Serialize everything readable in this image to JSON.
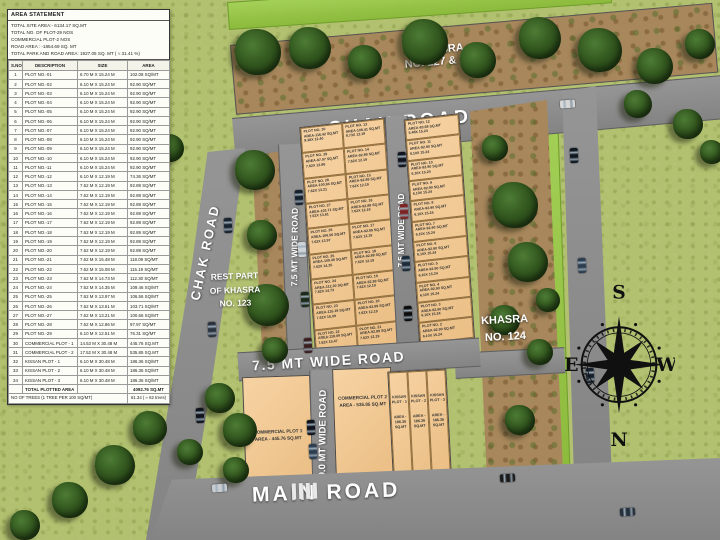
{
  "area_statement": {
    "title": "AREA STATEMENT",
    "summary_lines": [
      "TOTAL SITE AREA:- 6134.17 SQ.MT",
      "TOTAL NO. OF PLOT-29 NOS",
      "COMMERCIAL PLOT-2 NOS",
      "ROAD AREA : -1854.69 SQ. MT",
      "TOTAL PARK AND ROAD AREA: 1927.05 SQ. MT ( ≈ 31.41 %)"
    ],
    "columns": [
      "S.NO",
      "DESCRIPTION",
      "SIZE",
      "AREA"
    ],
    "rows": [
      [
        "1",
        "PLOT NO.-01",
        "6.70 M X 15.24 M",
        "102.08 SQ/MT"
      ],
      [
        "2",
        "PLOT NO.-02",
        "6.10 M X 15.24 M",
        "92.90 SQ/MT"
      ],
      [
        "3",
        "PLOT NO.-03",
        "6.10 M X 15.24 M",
        "92.90 SQ/MT"
      ],
      [
        "4",
        "PLOT NO.-04",
        "6.10 M X 15.24 M",
        "92.90 SQ/MT"
      ],
      [
        "5",
        "PLOT NO.-05",
        "6.10 M X 15.24 M",
        "92.90 SQ/MT"
      ],
      [
        "6",
        "PLOT NO.-06",
        "6.10 M X 15.24 M",
        "92.90 SQ/MT"
      ],
      [
        "7",
        "PLOT NO.-07",
        "6.10 M X 15.24 M",
        "92.90 SQ/MT"
      ],
      [
        "8",
        "PLOT NO.-08",
        "6.10 M X 15.24 M",
        "92.90 SQ/MT"
      ],
      [
        "9",
        "PLOT NO.-09",
        "6.10 M X 15.24 M",
        "92.90 SQ/MT"
      ],
      [
        "10",
        "PLOT NO.-10",
        "6.10 M X 15.24 M",
        "92.90 SQ/MT"
      ],
      [
        "11",
        "PLOT NO.-11",
        "6.10 M X 15.24 M",
        "92.90 SQ/MT"
      ],
      [
        "12",
        "PLOT NO.-12",
        "6.10 M X 12.19 M",
        "74.36 SQ/MT"
      ],
      [
        "13",
        "PLOT NO.-13",
        "7.62 M X 12.19 M",
        "92.89 SQ/MT"
      ],
      [
        "14",
        "PLOT NO.-14",
        "7.62 M X 12.19 M",
        "92.89 SQ/MT"
      ],
      [
        "15",
        "PLOT NO.-15",
        "7.62 M X 12.19 M",
        "92.89 SQ/MT"
      ],
      [
        "16",
        "PLOT NO.-16",
        "7.62 M X 12.19 M",
        "92.89 SQ/MT"
      ],
      [
        "17",
        "PLOT NO.-17",
        "7.62 M X 12.19 M",
        "92.89 SQ/MT"
      ],
      [
        "18",
        "PLOT NO.-18",
        "7.62 M X 12.19 M",
        "92.89 SQ/MT"
      ],
      [
        "19",
        "PLOT NO.-19",
        "7.62 M X 12.19 M",
        "92.89 SQ/MT"
      ],
      [
        "20",
        "PLOT NO.-20",
        "7.62 M X 12.19 M",
        "92.89 SQ/MT"
      ],
      [
        "21",
        "PLOT NO.-21",
        "7.62 M X 15.48 M",
        "118.09 SQ/MT"
      ],
      [
        "22",
        "PLOT NO.-22",
        "7.62 M X 15.08 M",
        "115.19 SQ/MT"
      ],
      [
        "23",
        "PLOT NO.-23",
        "7.62 M X 14.73 M",
        "112.30 SQ/MT"
      ],
      [
        "24",
        "PLOT NO.-24",
        "7.62 M X 14.35 M",
        "109.46 SQ/MT"
      ],
      [
        "25",
        "PLOT NO.-25",
        "7.62 M X 13.97 M",
        "106.56 SQ/MT"
      ],
      [
        "26",
        "PLOT NO.-26",
        "7.62 M X 13.61 M",
        "103.71 SQ/MT"
      ],
      [
        "27",
        "PLOT NO.-27",
        "7.62 M X 13.21 M",
        "100.66 SQ/MT"
      ],
      [
        "28",
        "PLOT NO.-28",
        "7.62 M X 12.86 M",
        "97.97 SQ/MT"
      ],
      [
        "29",
        "PLOT NO.-29",
        "6.10 M X 12.51 M",
        "76.31 SQ/MT"
      ],
      [
        "30",
        "COMMERCIAL PLOT - 1",
        "14.53 M X 30.48 M",
        "445.76 SQ.MT"
      ],
      [
        "31",
        "COMMERCIAL PLOT - 2",
        "17.52 M X 30.48 M",
        "535.85 SQ.MT"
      ],
      [
        "32",
        "KISSAN PLOT - 1",
        "6.10 M X 30.48 M",
        "186.36 SQ/MT"
      ],
      [
        "33",
        "KISSAN PLOT - 2",
        "6.10 M X 30.48 M",
        "186.36 SQ/MT"
      ],
      [
        "34",
        "KISSAN PLOT - 3",
        "6.10 M X 30.48 M",
        "186.36 SQ/MT"
      ]
    ],
    "total_row": {
      "label": "TOTAL PLOTTED AREA",
      "value": "4092.76 SQ.MT"
    },
    "trees_row": {
      "label": "NO OF TREES (1 TREE PER 100 SQ/MT)",
      "value": "61.34 ( ≈ 62 trees)"
    }
  },
  "plan": {
    "khasra_top": {
      "line1": "KHASRA",
      "line2": "NO. 127 & 128"
    },
    "khasra_right": {
      "line1": "KHASRA",
      "line2": "NO. 124"
    },
    "khasra_rest": {
      "line1": "REST PART",
      "line2": "OF KHASRA",
      "line3": "NO. 123"
    },
    "roads": {
      "chak_road_top": "CHAK ROAD",
      "chak_road_left": "CHAK ROAD",
      "road_75_left": "7.5 MT WIDE ROAD",
      "road_75_right": "7.5 MT WIDE ROAD",
      "road_75_horizontal": "7.5 MT WIDE ROAD",
      "road_90": "9.0 MT WIDE ROAD",
      "main_road": "MAIN ROAD"
    },
    "middle_left": [
      [
        "PLOT NO. 30",
        "AREA-116.42 SQ.MT",
        "9.38X 12.40"
      ],
      [
        "PLOT NO. 29",
        "AREA-97.97 SQ.MT",
        "7.62X 12.86"
      ],
      [
        "PLOT NO. 28",
        "AREA-100.94 SQ.MT",
        "7.62X 13.21"
      ],
      [
        "PLOT NO. 27",
        "AREA-103.71 SQ.MT",
        "7.62X 13.61"
      ],
      [
        "PLOT NO. 26",
        "AREA-106.56 SQ.MT",
        "7.62X 13.97"
      ],
      [
        "PLOT NO. 25",
        "AREA-109.46 SQ.MT",
        "7.62X 14.35"
      ],
      [
        "PLOT NO. 24",
        "AREA-112.30 SQ.MT",
        "7.62X 14.73"
      ],
      [
        "PLOT NO. 23",
        "AREA-115.19 SQ.MT",
        "7.62X 15.09"
      ],
      [
        "PLOT NO. 22",
        "AREA-118.09 SQ.MT",
        "7.62X 15.47"
      ]
    ],
    "middle_right": [
      [
        "PLOT NO. 13",
        "AREA-106.41 SQ.MT",
        "8.73X 12.19"
      ],
      [
        "PLOT NO. 14",
        "AREA-92.89 SQ.MT",
        "7.62X 12.19"
      ],
      [
        "PLOT NO. 15",
        "AREA-92.89 SQ.MT",
        "7.62X 12.19"
      ],
      [
        "PLOT NO. 16",
        "AREA-92.89 SQ.MT",
        "7.62X 12.19"
      ],
      [
        "PLOT NO. 17",
        "AREA-92.89 SQ.MT",
        "7.62X 12.19"
      ],
      [
        "PLOT NO. 18",
        "AREA-92.89 SQ.MT",
        "7.62X 12.19"
      ],
      [
        "PLOT NO. 19",
        "AREA-92.89 SQ.MT",
        "7.62X 12.19"
      ],
      [
        "PLOT NO. 20",
        "AREA-92.89 SQ.MT",
        "7.62X 12.19"
      ],
      [
        "PLOT NO. 21",
        "AREA-92.89 SQ.MT",
        "7.62X 12.19"
      ]
    ],
    "right_block": [
      [
        "PLOT NO. 12",
        "AREA-83.68 SQ.MT",
        "5.48X 15.24"
      ],
      [
        "PLOT NO. 11",
        "AREA-92.90 SQ.MT",
        "6.10X 15.24"
      ],
      [
        "PLOT NO. 10",
        "AREA-92.90 SQ.MT",
        "6.10X 15.24"
      ],
      [
        "PLOT NO. 9",
        "AREA-92.90 SQ.MT",
        "6.10X 15.24"
      ],
      [
        "PLOT NO. 8",
        "AREA-92.90 SQ.MT",
        "6.10X 15.24"
      ],
      [
        "PLOT NO. 7",
        "AREA-92.90 SQ.MT",
        "6.10X 15.24"
      ],
      [
        "PLOT NO. 6",
        "AREA-92.90 SQ.MT",
        "6.10X 15.24"
      ],
      [
        "PLOT NO. 5",
        "AREA-92.90 SQ.MT",
        "6.10X 15.24"
      ],
      [
        "PLOT NO. 4",
        "AREA-92.90 SQ.MT",
        "6.10X 15.24"
      ],
      [
        "PLOT NO. 3",
        "AREA-92.90 SQ.MT",
        "6.10X 15.24"
      ],
      [
        "PLOT NO. 2",
        "AREA-92.90 SQ.MT",
        "6.10X 15.24"
      ],
      [
        "PLOT NO. 1",
        "AREA-102.08 SQ.MT",
        "6.70X 15.24"
      ]
    ],
    "commercial": [
      {
        "name": "COMMERCIAL PLOT 1",
        "area": "AREA - 445.76 SQ.MT"
      },
      {
        "name": "COMMERCIAL PLOT 2",
        "area": "AREA - 535.85 SQ.MT"
      }
    ],
    "kissan": [
      {
        "lines": [
          "KISSAN",
          "PLOT - 1",
          "AREA -",
          "186.36",
          "SQ.MT"
        ]
      },
      {
        "lines": [
          "KISSAN",
          "PLOT - 2",
          "AREA -",
          "186.36",
          "SQ.MT"
        ]
      },
      {
        "lines": [
          "KISSAN",
          "PLOT - 3",
          "AREA -",
          "186.36",
          "SQ.MT"
        ]
      }
    ],
    "compass": {
      "n": "N",
      "s": "S",
      "e": "E",
      "w": "W"
    }
  },
  "colors": {
    "background_green": "#b2c170",
    "bright_green": "#98ca41",
    "road_gray": "#8f8f8f",
    "plot_tan": "#f5c98f",
    "khasra_brown": "#a8875c",
    "tree_green": "#2f4f1f",
    "label_white": "#ffffff"
  }
}
